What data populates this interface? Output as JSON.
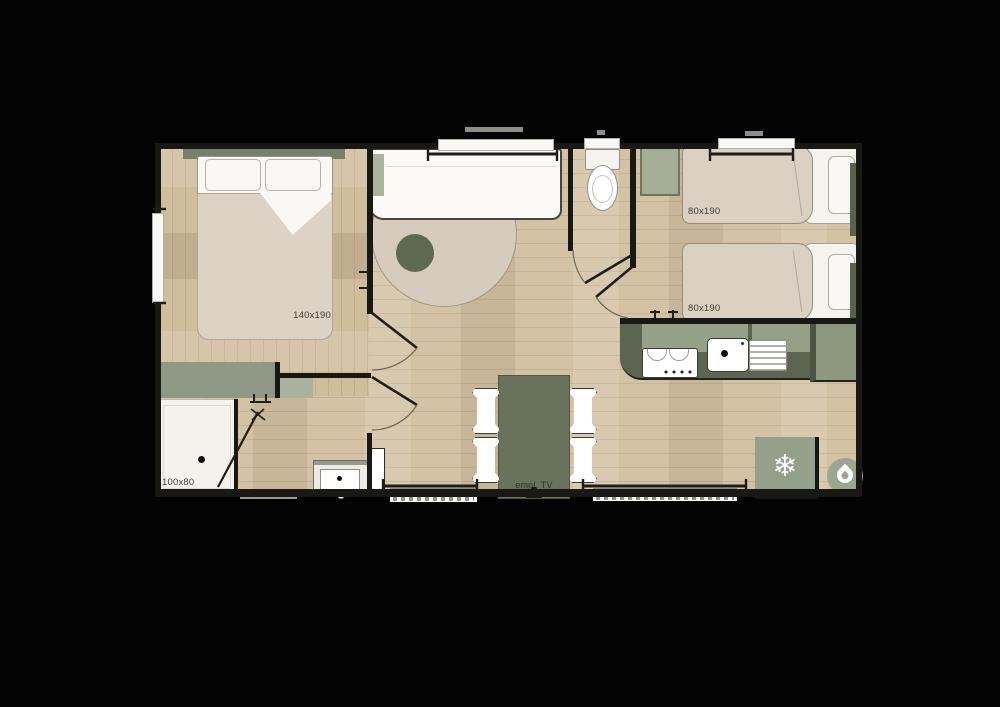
{
  "labels": {
    "master_bed": "140x190",
    "twin_bed_top": "80x190",
    "twin_bed_bottom": "80x190",
    "shower": "100x80",
    "tv_spot": "empl. TV"
  },
  "icons": {
    "fridge_glyph": "❄",
    "fridge": "snowflake-icon",
    "water_heater": "droplet-icon"
  },
  "colors": {
    "background": "#040404",
    "wall": "#181815",
    "wood": "#d3c2a4",
    "sage": "#95a086",
    "sage_dark": "#5c6550",
    "table_green": "#69735b",
    "mattress_beige": "#dad1c2",
    "rug_beige": "#d6ccbd",
    "white_fixture": "#f9f8f4"
  }
}
